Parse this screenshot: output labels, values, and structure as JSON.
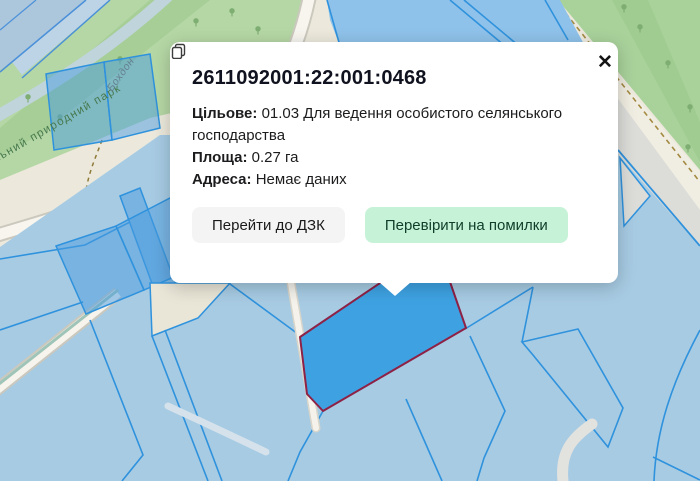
{
  "popup": {
    "title": "2611092001:22:001:0468",
    "close_label": "✕",
    "fields": [
      {
        "label": "Цільове:",
        "value": "01.03 Для ведення особистого селянського господарства"
      },
      {
        "label": "Площа:",
        "value": "0.27 га"
      },
      {
        "label": "Адреса:",
        "value": "Немає даних"
      }
    ],
    "buttons": [
      {
        "label": "Перейти до ДЗК"
      },
      {
        "label": "Перевірити на помилки"
      }
    ]
  },
  "map": {
    "labels": {
      "park": "національний природний парк",
      "river": "Бохдон"
    },
    "colors": {
      "parcel_fill": "#A7CBE3",
      "parcel_border": "#2F92DD",
      "selected_parcel_fill": "#3EA2E2",
      "selected_parcel_border": "#8E2146",
      "forest_green": "#A9D29B",
      "park_green": "#B5D7A5",
      "road_beige": "#F6F4ED",
      "button_green": "#C6F3D8"
    }
  }
}
